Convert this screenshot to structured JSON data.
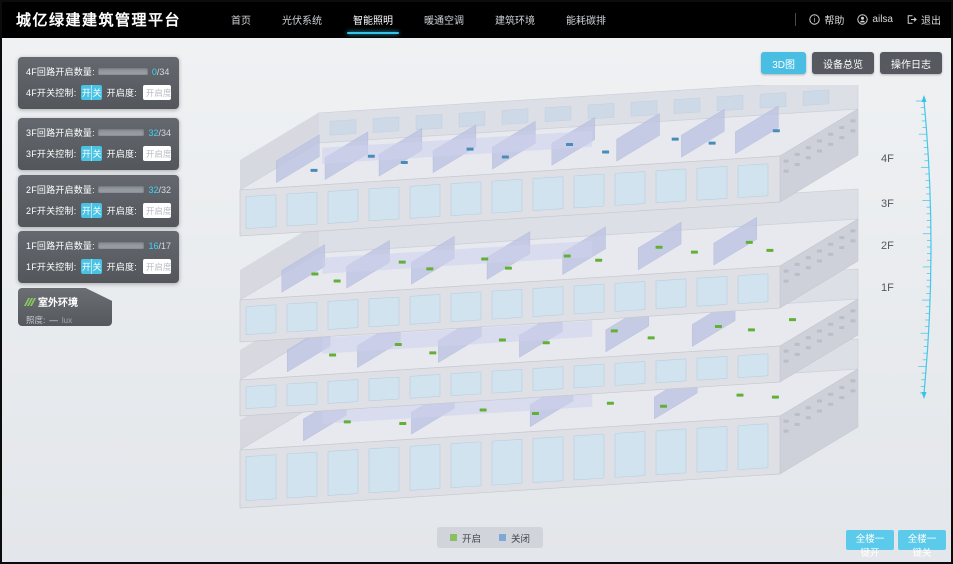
{
  "header": {
    "title": "城亿绿建建筑管理平台",
    "nav": [
      {
        "label": "首页",
        "active": false
      },
      {
        "label": "光伏系统",
        "active": false
      },
      {
        "label": "智能照明",
        "active": true
      },
      {
        "label": "暖通空调",
        "active": false
      },
      {
        "label": "建筑环境",
        "active": false
      },
      {
        "label": "能耗碳排",
        "active": false
      }
    ],
    "help_label": "帮助",
    "username": "ailsa",
    "logout_label": "退出"
  },
  "view_toolbar": {
    "buttons": [
      {
        "label": "3D图",
        "active": true
      },
      {
        "label": "设备总览",
        "active": false
      },
      {
        "label": "操作日志",
        "active": false
      }
    ]
  },
  "floor_panels": [
    {
      "count_label": "4F回路开启数量:",
      "count_on": "0",
      "count_total": "/34",
      "bar_style": "width:0%",
      "switch_label": "4F开关控制:",
      "on_label": "开",
      "off_label": "关",
      "openness_label": "开启度:",
      "openness_placeholder": "开启度",
      "percent_label": "%"
    },
    {
      "count_label": "3F回路开启数量:",
      "count_on": "32",
      "count_total": "/34",
      "bar_style": "width:92%",
      "switch_label": "3F开关控制:",
      "on_label": "开",
      "off_label": "关",
      "openness_label": "开启度:",
      "openness_placeholder": "开启度",
      "percent_label": "%"
    },
    {
      "count_label": "2F回路开启数量:",
      "count_on": "32",
      "count_total": "/32",
      "bar_style": "width:96%",
      "switch_label": "2F开关控制:",
      "on_label": "开",
      "off_label": "关",
      "openness_label": "开启度:",
      "openness_placeholder": "开启度",
      "percent_label": "%"
    },
    {
      "count_label": "1F回路开启数量:",
      "count_on": "16",
      "count_total": "/17",
      "bar_style": "width:92%",
      "switch_label": "1F开关控制:",
      "on_label": "开",
      "off_label": "关",
      "openness_label": "开启度:",
      "openness_placeholder": "开启度",
      "percent_label": "%"
    }
  ],
  "outdoor_panel": {
    "title": "室外环境",
    "metric_label": "照度:",
    "metric_value": "—",
    "metric_unit": "lux"
  },
  "floor_markers": [
    "4F",
    "3F",
    "2F",
    "1F"
  ],
  "legend": {
    "items": [
      {
        "label": "开启",
        "swatch_style": "background:#8bbf61"
      },
      {
        "label": "关闭",
        "swatch_style": "background:#7ea9d4"
      }
    ]
  },
  "bulk_controls": {
    "buttons": [
      {
        "label": "全楼一键开"
      },
      {
        "label": "全楼一键关"
      }
    ]
  },
  "building": {
    "dot_on_color": "#63b037",
    "dot_off_color": "#4a8cb8",
    "accent_color": "#35c3e8"
  }
}
